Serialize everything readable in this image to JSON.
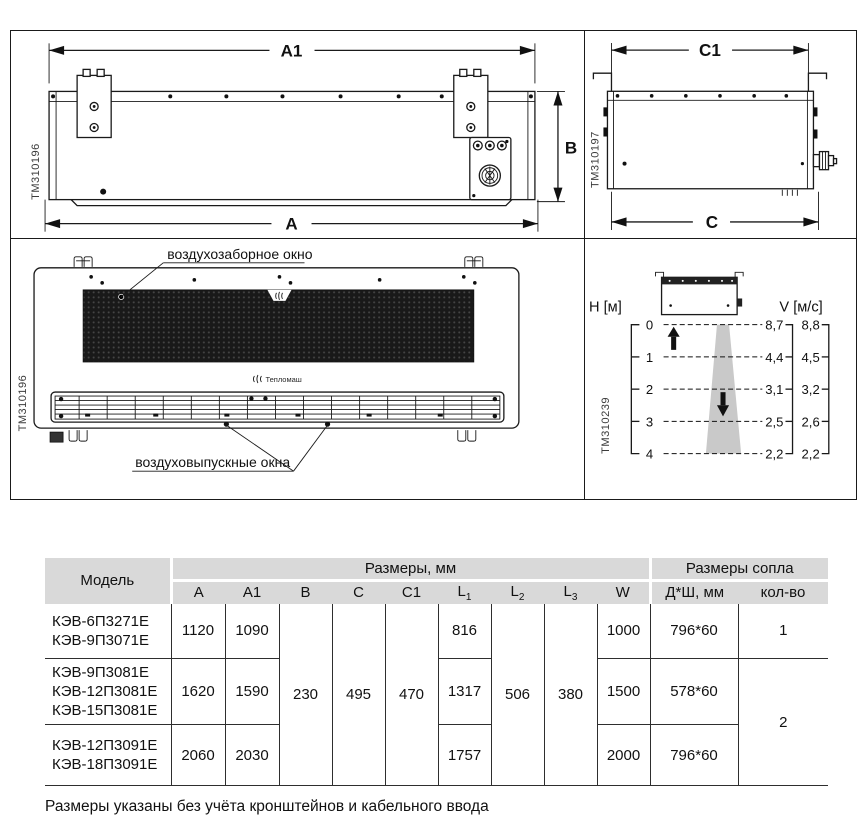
{
  "drawings": {
    "rear_view": {
      "code": "TM310196",
      "dim_width_top": "A1",
      "dim_width_bottom": "A",
      "dim_height": "B"
    },
    "side_view": {
      "code": "TM310197",
      "dim_depth_top": "C1",
      "dim_depth_bottom": "C"
    },
    "front_view": {
      "code": "TM310196",
      "intake_label": "воздухозаборное окно",
      "outlet_label": "воздуховыпускные окна",
      "brand": "Тепломаш"
    },
    "airflow": {
      "code": "TM310239",
      "h_axis_label": "Н [м]",
      "v_axis_label": "V [м/с]",
      "heights": [
        "0",
        "1",
        "2",
        "3",
        "4"
      ],
      "v_inner": [
        "8,7",
        "4,4",
        "3,1",
        "2,5",
        "2,2"
      ],
      "v_outer": [
        "8,8",
        "4,5",
        "3,2",
        "2,6",
        "2,2"
      ]
    }
  },
  "table": {
    "header": {
      "model": "Модель",
      "dims_group": "Размеры, мм",
      "nozzle_group": "Размеры сопла",
      "col_a": "A",
      "col_a1": "A1",
      "col_b": "B",
      "col_c": "C",
      "col_c1": "C1",
      "col_l": "L",
      "sub_1": "1",
      "sub_2": "2",
      "sub_3": "3",
      "col_w": "W",
      "col_nozzle": "Д*Ш, мм",
      "col_qty": "кол-во"
    },
    "merged": {
      "b": "230",
      "c": "495",
      "c1": "470",
      "l2": "506",
      "l3": "380",
      "qty_23": "2"
    },
    "rows": [
      {
        "models": [
          "КЭВ-6П3271Е",
          "КЭВ-9П3071Е"
        ],
        "a": "1120",
        "a1": "1090",
        "l1": "816",
        "w": "1000",
        "nozzle": "796*60",
        "qty": "1"
      },
      {
        "models": [
          "КЭВ-9П3081Е",
          "КЭВ-12П3081Е",
          "КЭВ-15П3081Е"
        ],
        "a": "1620",
        "a1": "1590",
        "l1": "1317",
        "w": "1500",
        "nozzle": "578*60"
      },
      {
        "models": [
          "КЭВ-12П3091Е",
          "КЭВ-18П3091Е"
        ],
        "a": "2060",
        "a1": "2030",
        "l1": "1757",
        "w": "2000",
        "nozzle": "796*60"
      }
    ],
    "footnote": "Размеры указаны без учёта кронштейнов и кабельного ввода"
  }
}
